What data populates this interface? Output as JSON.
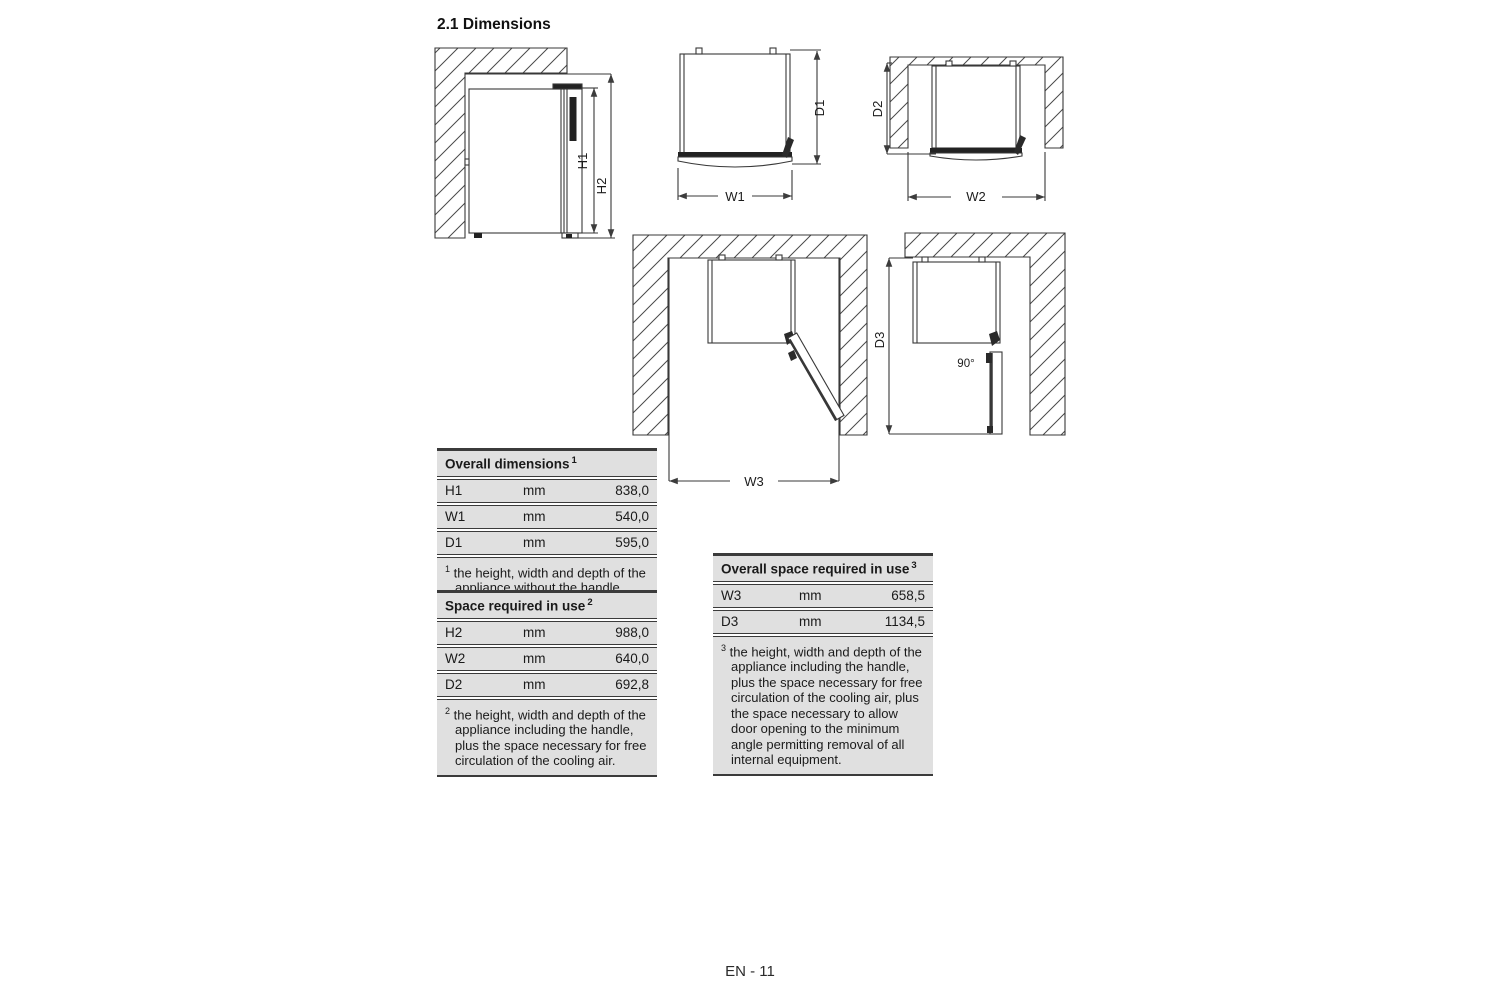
{
  "page": {
    "title": "2.1 Dimensions",
    "footer": "EN - 11"
  },
  "diagram_labels": {
    "h1": "H1",
    "h2": "H2",
    "w1": "W1",
    "d1": "D1",
    "d2": "D2",
    "w2": "W2",
    "w3": "W3",
    "d3": "D3",
    "angle": "90°"
  },
  "tables": {
    "overall_dimensions": {
      "title": "Overall dimensions",
      "title_sup": "1",
      "rows": [
        {
          "label": "H1",
          "unit": "mm",
          "value": "838,0"
        },
        {
          "label": "W1",
          "unit": "mm",
          "value": "540,0"
        },
        {
          "label": "D1",
          "unit": "mm",
          "value": "595,0"
        }
      ],
      "footnote_sup": "1",
      "footnote": "the height, width and depth of the appliance without the handle."
    },
    "space_required": {
      "title": "Space required in use",
      "title_sup": "2",
      "rows": [
        {
          "label": "H2",
          "unit": "mm",
          "value": "988,0"
        },
        {
          "label": "W2",
          "unit": "mm",
          "value": "640,0"
        },
        {
          "label": "D2",
          "unit": "mm",
          "value": "692,8"
        }
      ],
      "footnote_sup": "2",
      "footnote": "the height, width and depth of the appliance including the handle, plus the space necessary for free circulation of the cooling air."
    },
    "overall_space_required": {
      "title": "Overall space required in use",
      "title_sup": "3",
      "rows": [
        {
          "label": "W3",
          "unit": "mm",
          "value": "658,5"
        },
        {
          "label": "D3",
          "unit": "mm",
          "value": "1134,5"
        }
      ],
      "footnote_sup": "3",
      "footnote": "the height, width and depth of the appliance including the handle, plus the space necessary for free circulation of the cooling air, plus the space necessary to allow door opening to the minimum angle permitting removal of all internal equipment."
    }
  }
}
